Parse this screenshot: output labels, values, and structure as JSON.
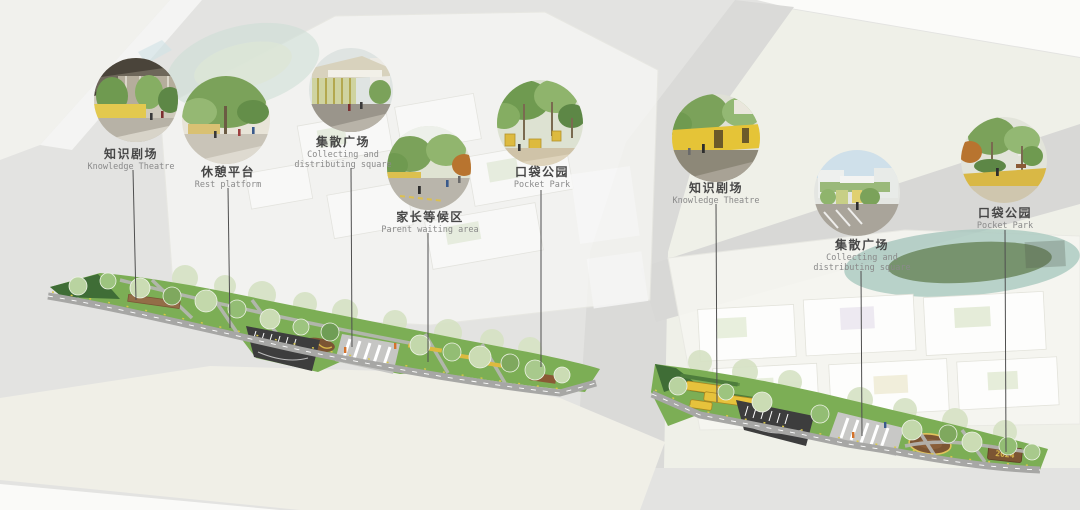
{
  "diagrams": [
    {
      "name": "west-campus-plan",
      "callouts": [
        {
          "zh": "知识剧场",
          "en": "Knowledge Theatre"
        },
        {
          "zh": "休憩平台",
          "en": "Rest platform"
        },
        {
          "zh": "集散广场",
          "en": "Collecting and distributing square"
        },
        {
          "zh": "家长等候区",
          "en": "Parent waiting area"
        },
        {
          "zh": "口袋公园",
          "en": "Pocket Park"
        }
      ]
    },
    {
      "name": "east-campus-plan",
      "sign_text": "2024",
      "callouts": [
        {
          "zh": "知识剧场",
          "en": "Knowledge Theatre"
        },
        {
          "zh": "集散广场",
          "en": "Collecting and distributing square"
        },
        {
          "zh": "口袋公园",
          "en": "Pocket Park"
        }
      ]
    }
  ],
  "colors": {
    "background": "#e3e3e1",
    "campus_pale": "#eff0e8",
    "cream_ground": "#f0efe7",
    "road_band": "#dadad8",
    "grass": "#7cae55",
    "dark_green": "#3f6d36",
    "asphalt": "#3d3d3d",
    "accent_yellow": "#e6c23c",
    "leader_line": "#4f4f4f",
    "label_zh": "#474747",
    "label_en": "#8a8a8a"
  }
}
